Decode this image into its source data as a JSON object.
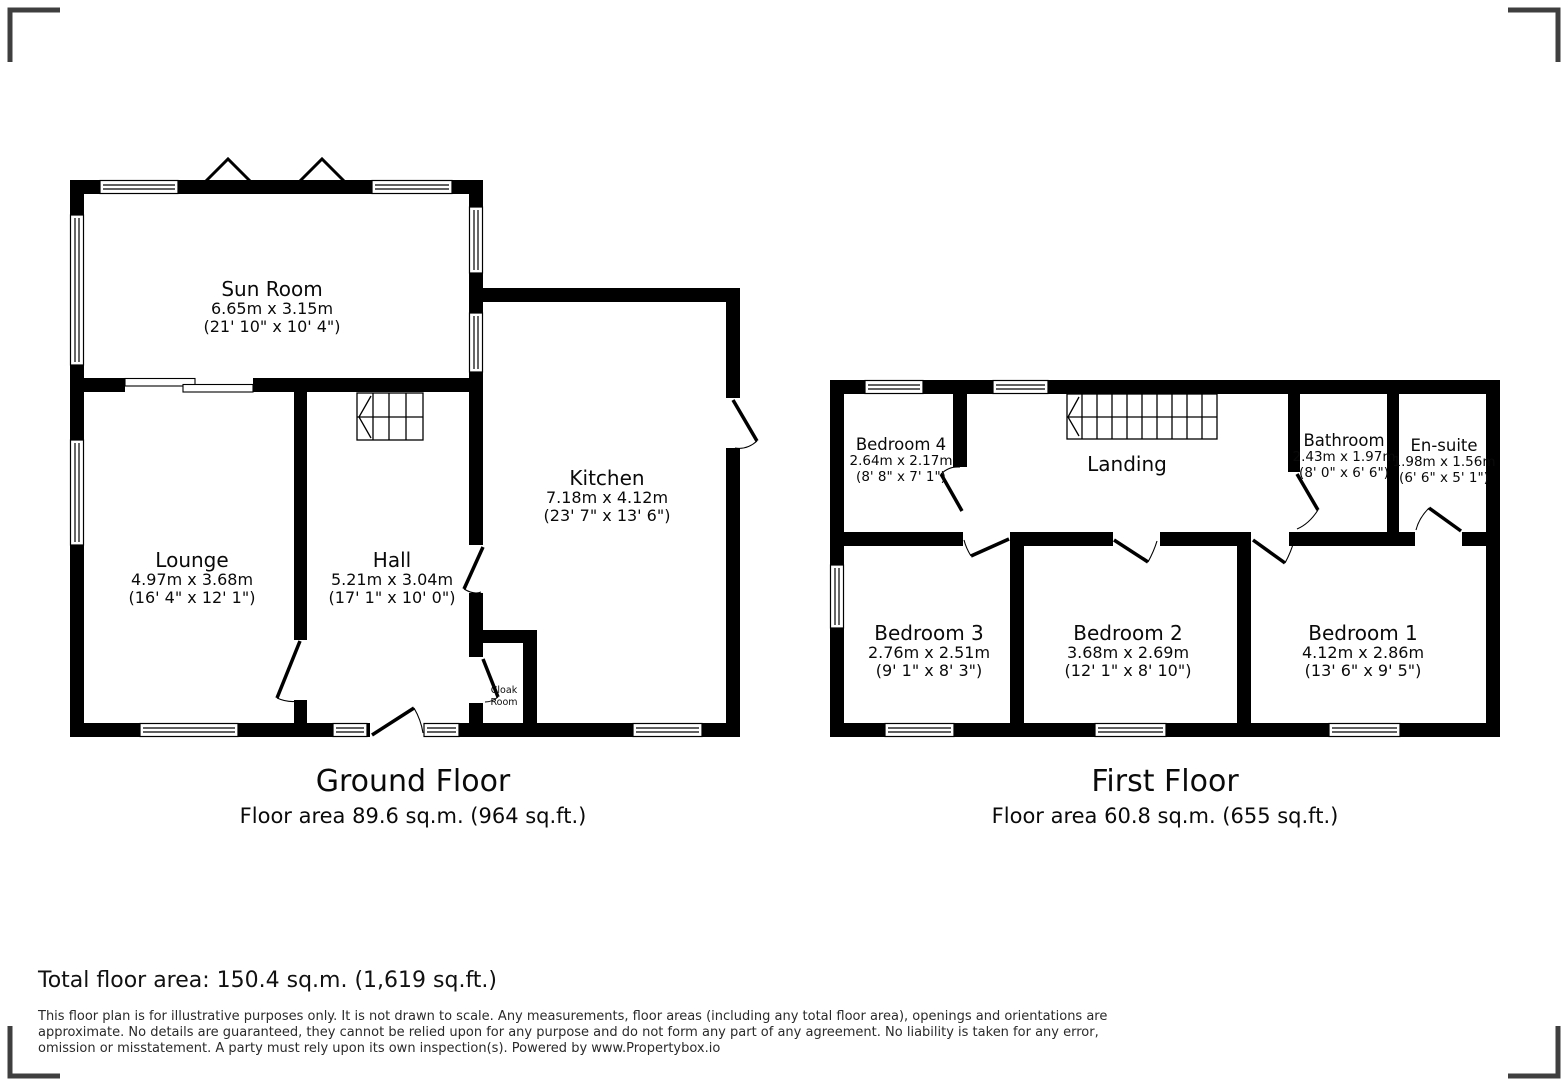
{
  "ground_floor": {
    "title": "Ground Floor",
    "floor_area": "Floor area 89.6 sq.m. (964 sq.ft.)",
    "rooms": {
      "sun_room": {
        "name": "Sun Room",
        "dims_m": "6.65m x 3.15m",
        "dims_ft": "(21' 10\" x 10' 4\")"
      },
      "lounge": {
        "name": "Lounge",
        "dims_m": "4.97m x 3.68m",
        "dims_ft": "(16' 4\" x 12' 1\")"
      },
      "hall": {
        "name": "Hall",
        "dims_m": "5.21m x 3.04m",
        "dims_ft": "(17' 1\" x 10' 0\")"
      },
      "kitchen": {
        "name": "Kitchen",
        "dims_m": "7.18m x 4.12m",
        "dims_ft": "(23' 7\" x 13' 6\")"
      },
      "cloak_room": {
        "line1": "Cloak",
        "line2": "Room"
      }
    }
  },
  "first_floor": {
    "title": "First Floor",
    "floor_area": "Floor area 60.8 sq.m. (655 sq.ft.)",
    "rooms": {
      "bedroom4": {
        "name": "Bedroom 4",
        "dims_m": "2.64m x 2.17m",
        "dims_ft": "(8' 8\" x 7' 1\")"
      },
      "landing": {
        "name": "Landing"
      },
      "bathroom": {
        "name": "Bathroom",
        "dims_m": "2.43m x 1.97m",
        "dims_ft": "(8' 0\" x 6' 6\")"
      },
      "ensuite": {
        "name": "En-suite",
        "dims_m": "1.98m x 1.56m",
        "dims_ft": "(6' 6\" x 5' 1\")"
      },
      "bedroom3": {
        "name": "Bedroom 3",
        "dims_m": "2.76m x 2.51m",
        "dims_ft": "(9' 1\" x 8' 3\")"
      },
      "bedroom2": {
        "name": "Bedroom 2",
        "dims_m": "3.68m x 2.69m",
        "dims_ft": "(12' 1\" x 8' 10\")"
      },
      "bedroom1": {
        "name": "Bedroom 1",
        "dims_m": "4.12m x 2.86m",
        "dims_ft": "(13' 6\" x 9' 5\")"
      }
    }
  },
  "footer": {
    "total_area": "Total floor area: 150.4 sq.m. (1,619 sq.ft.)",
    "disclaimer_lines": [
      "This floor plan is for illustrative purposes only. It is not drawn to scale. Any measurements, floor areas (including any total floor area), openings and orientations are",
      "approximate. No details are guaranteed, they cannot be relied upon for any purpose and do not form any part of any agreement. No liability is taken for any error,",
      "omission or misstatement. A party must rely upon its own inspection(s). Powered by www.Propertybox.io"
    ]
  },
  "colors": {
    "wall": "#000000",
    "corner_mark": "#3f3f3f",
    "background": "#ffffff"
  }
}
